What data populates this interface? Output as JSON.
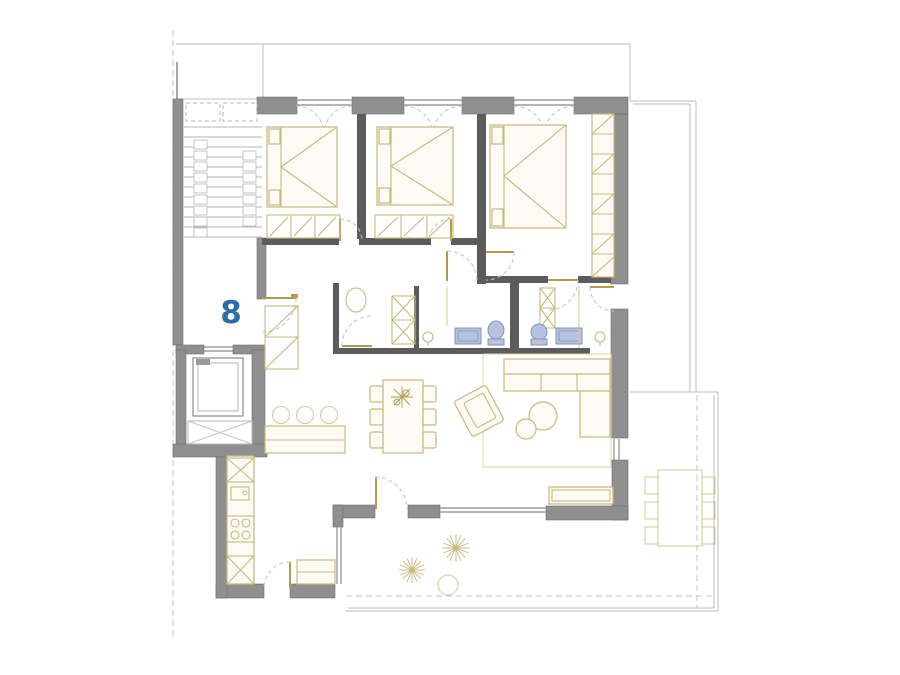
{
  "plan": {
    "unit_number": "8",
    "drawing_type": "apartment-floor-plan",
    "colors": {
      "background": "#ffffff",
      "exterior_wall": "#8f8f8f",
      "interior_wall": "#5c5c5c",
      "furniture_outline": "#c9b87d",
      "furniture_fill": "#fdfbf3",
      "fixture_fill": "#b7c3de",
      "fixture_stroke": "#8294b8",
      "thin_outline": "#bcbcbc",
      "unit_number_color": "#2d6da3"
    },
    "rooms": [
      "staircase-landing",
      "elevator",
      "entry-hall",
      "corridor",
      "bedroom-1",
      "bedroom-2",
      "master-bedroom",
      "laundry-wc",
      "bathroom-1",
      "bathroom-2",
      "kitchen",
      "dining-area",
      "living-room",
      "south-terrace",
      "east-terrace"
    ],
    "furniture_and_fixtures": [
      "double-bed-1",
      "double-bed-2",
      "master-bed",
      "foot-bench-1",
      "foot-bench-2",
      "wardrobe",
      "entry-closet",
      "washer-dryer-stack",
      "toilet-1",
      "toilet-2",
      "sink-cabinet-1",
      "sink-cabinet-2",
      "pedestal-sink-1",
      "pedestal-sink-2",
      "kitchen-counter",
      "kitchen-sink",
      "stove",
      "kitchen-peninsula",
      "bar-stools",
      "dining-table-with-6-chairs",
      "table-plant",
      "l-shaped-sofa",
      "armchair",
      "coffee-tables",
      "rug",
      "sideboard",
      "terrace-cabinet",
      "outdoor-dining-table-with-6-chairs",
      "potted-plant-1",
      "potted-plant-2",
      "round-planter"
    ]
  }
}
